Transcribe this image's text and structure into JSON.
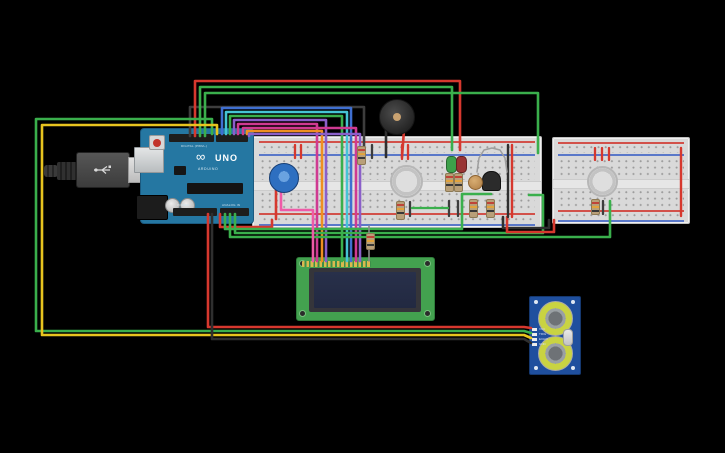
{
  "scene": {
    "background": "#000000"
  },
  "arduino": {
    "model": "UNO",
    "brand": "ARDUINO",
    "logo": "∞",
    "digital_label": "DIGITAL (PWM~)",
    "power_label": "POWER",
    "analog_label": "ANALOG IN"
  },
  "ultrasonic": {
    "pin_labels": [
      "VCC",
      "TRIG",
      "ECHO",
      "GND"
    ]
  },
  "palette": {
    "red": "#d6382e",
    "green": "#3aaf4c",
    "yellow": "#e7c41f",
    "black": "#2f2f2f",
    "dark": "#3d3d3d",
    "orange": "#ef8f21",
    "magenta": "#cf3a92",
    "pink": "#ef5aa7",
    "purple": "#8a5fc9",
    "cyan": "#45c4d4",
    "blue": "#3f6fd1",
    "gray": "#8a8a8a",
    "board_blue": "#2577a2",
    "lcd_green": "#43a14f",
    "sonar_blue": "#1f4f9e",
    "breadboard": "#d9d9d9"
  },
  "wires": [
    {
      "name": "gray-buzzer-signal",
      "color": "#3d3d3d",
      "pts": [
        [
          190,
          136
        ],
        [
          190,
          107
        ],
        [
          364,
          107
        ],
        [
          364,
          157
        ]
      ]
    },
    {
      "name": "red-top-loop",
      "color": "#d6382e",
      "pts": [
        [
          195,
          136
        ],
        [
          195,
          81
        ],
        [
          460,
          81
        ],
        [
          460,
          150
        ]
      ]
    },
    {
      "name": "green-top-a",
      "color": "#3aaf4c",
      "pts": [
        [
          200,
          136
        ],
        [
          200,
          87
        ],
        [
          452,
          87
        ],
        [
          452,
          150
        ]
      ]
    },
    {
      "name": "green-top-b",
      "color": "#3aaf4c",
      "pts": [
        [
          205,
          136
        ],
        [
          205,
          93
        ],
        [
          538,
          93
        ],
        [
          538,
          153
        ]
      ]
    },
    {
      "name": "green-echo",
      "color": "#3aaf4c",
      "pts": [
        [
          212,
          134
        ],
        [
          212,
          119
        ],
        [
          36,
          119
        ],
        [
          36,
          331
        ],
        [
          524,
          331
        ],
        [
          531,
          333
        ]
      ]
    },
    {
      "name": "yellow-trig",
      "color": "#e7c41f",
      "pts": [
        [
          217,
          134
        ],
        [
          217,
          125
        ],
        [
          42,
          125
        ],
        [
          42,
          335
        ],
        [
          524,
          335
        ],
        [
          531,
          338
        ]
      ]
    },
    {
      "name": "blue-lcd",
      "color": "#3f6fd1",
      "pts": [
        [
          222,
          134
        ],
        [
          222,
          108
        ],
        [
          351,
          108
        ],
        [
          351,
          261
        ]
      ]
    },
    {
      "name": "cyan-lcd",
      "color": "#45c4d4",
      "pts": [
        [
          226,
          134
        ],
        [
          226,
          112
        ],
        [
          347,
          112
        ],
        [
          347,
          261
        ]
      ]
    },
    {
      "name": "green-lcd",
      "color": "#3aaf4c",
      "pts": [
        [
          230,
          134
        ],
        [
          230,
          116
        ],
        [
          342,
          116
        ],
        [
          342,
          261
        ]
      ]
    },
    {
      "name": "purple-lcd-a",
      "color": "#8a5fc9",
      "pts": [
        [
          234,
          134
        ],
        [
          234,
          120
        ],
        [
          326,
          120
        ],
        [
          326,
          261
        ]
      ]
    },
    {
      "name": "magenta-lcd-a",
      "color": "#cf3a92",
      "pts": [
        [
          238,
          134
        ],
        [
          238,
          124
        ],
        [
          317,
          124
        ],
        [
          317,
          261
        ]
      ]
    },
    {
      "name": "magenta-lcd-b",
      "color": "#cf3a92",
      "pts": [
        [
          243,
          134
        ],
        [
          243,
          128
        ],
        [
          356,
          128
        ],
        [
          356,
          261
        ]
      ]
    },
    {
      "name": "orange-lcd",
      "color": "#ef8f21",
      "pts": [
        [
          247,
          134
        ],
        [
          247,
          131
        ],
        [
          322,
          131
        ],
        [
          322,
          261
        ]
      ]
    },
    {
      "name": "purple-lcd-b",
      "color": "#8a5fc9",
      "pts": [
        [
          249,
          136
        ],
        [
          249,
          134
        ],
        [
          360,
          134
        ],
        [
          360,
          261
        ]
      ]
    },
    {
      "name": "red-5v-sensor",
      "color": "#d6382e",
      "pts": [
        [
          208,
          214
        ],
        [
          208,
          327
        ],
        [
          524,
          327
        ],
        [
          531,
          328
        ]
      ]
    },
    {
      "name": "black-gnd-sensor",
      "color": "#2f2f2f",
      "pts": [
        [
          212,
          214
        ],
        [
          212,
          339
        ],
        [
          524,
          339
        ],
        [
          531,
          343
        ]
      ]
    },
    {
      "name": "red-rail-feed",
      "color": "#d6382e",
      "pts": [
        [
          220,
          214
        ],
        [
          220,
          227
        ],
        [
          272,
          227
        ],
        [
          272,
          220
        ]
      ]
    },
    {
      "name": "green-analog-a",
      "color": "#3aaf4c",
      "pts": [
        [
          225,
          214
        ],
        [
          225,
          229
        ],
        [
          462,
          229
        ],
        [
          462,
          194
        ],
        [
          491,
          194
        ]
      ]
    },
    {
      "name": "green-analog-c",
      "color": "#3aaf4c",
      "pts": [
        [
          235,
          214
        ],
        [
          235,
          233
        ],
        [
          543,
          233
        ],
        [
          543,
          195
        ],
        [
          529,
          195
        ]
      ]
    },
    {
      "name": "green-analog-b",
      "color": "#3aaf4c",
      "pts": [
        [
          230,
          214
        ],
        [
          230,
          237
        ],
        [
          610,
          237
        ],
        [
          610,
          201
        ]
      ]
    },
    {
      "name": "black-right-feed",
      "color": "#2f2f2f",
      "pts": [
        [
          503,
          217
        ],
        [
          503,
          228
        ],
        [
          549,
          228
        ],
        [
          549,
          220
        ]
      ]
    },
    {
      "name": "red-right-feed",
      "color": "#d6382e",
      "pts": [
        [
          507,
          217
        ],
        [
          507,
          232
        ],
        [
          554,
          232
        ],
        [
          554,
          220
        ]
      ]
    },
    {
      "name": "black-long-main",
      "color": "#2f2f2f",
      "w": 2.4,
      "pts": [
        [
          508,
          145
        ],
        [
          508,
          217
        ]
      ]
    },
    {
      "name": "red-long-main",
      "color": "#d6382e",
      "w": 2.4,
      "pts": [
        [
          512,
          145
        ],
        [
          512,
          217
        ]
      ]
    },
    {
      "name": "red-long-right",
      "color": "#d6382e",
      "w": 2.4,
      "pts": [
        [
          681,
          148
        ],
        [
          681,
          216
        ]
      ]
    },
    {
      "name": "buzzer-leg-black",
      "color": "#2f2f2f",
      "pts": [
        [
          386,
          129
        ],
        [
          386,
          157
        ]
      ]
    },
    {
      "name": "buzzer-leg-red",
      "color": "#d6382e",
      "pts": [
        [
          404,
          130
        ],
        [
          402,
          157
        ]
      ]
    },
    {
      "name": "pink-pot-lcd",
      "color": "#ef5aa7",
      "pts": [
        [
          281,
          188
        ],
        [
          281,
          210
        ],
        [
          313,
          210
        ],
        [
          313,
          261
        ]
      ]
    },
    {
      "name": "red-pot-leg",
      "color": "#d6382e",
      "pts": [
        [
          276,
          188
        ],
        [
          276,
          219
        ]
      ]
    },
    {
      "name": "red-jumper-1",
      "color": "#d6382e",
      "w": 2.3,
      "pts": [
        [
          295,
          145
        ],
        [
          295,
          158
        ]
      ]
    },
    {
      "name": "red-jumper-2",
      "color": "#d6382e",
      "w": 2.3,
      "pts": [
        [
          301,
          145
        ],
        [
          301,
          158
        ]
      ]
    },
    {
      "name": "red-jumper-3",
      "color": "#d6382e",
      "w": 2.3,
      "pts": [
        [
          402,
          145
        ],
        [
          402,
          159
        ]
      ]
    },
    {
      "name": "red-jumper-4",
      "color": "#d6382e",
      "w": 2.3,
      "pts": [
        [
          408,
          145
        ],
        [
          408,
          159
        ]
      ]
    },
    {
      "name": "red-jumper-5",
      "color": "#d6382e",
      "w": 2.3,
      "pts": [
        [
          595,
          148
        ],
        [
          595,
          160
        ]
      ]
    },
    {
      "name": "red-jumper-6",
      "color": "#d6382e",
      "w": 2.3,
      "pts": [
        [
          602,
          148
        ],
        [
          602,
          160
        ]
      ]
    },
    {
      "name": "red-jumper-7",
      "color": "#d6382e",
      "w": 2.3,
      "pts": [
        [
          609,
          148
        ],
        [
          609,
          160
        ]
      ]
    },
    {
      "name": "dark-jumper-1",
      "color": "#3d3d3d",
      "w": 2.3,
      "pts": [
        [
          449,
          201
        ],
        [
          449,
          216
        ]
      ]
    },
    {
      "name": "dark-jumper-2",
      "color": "#3d3d3d",
      "w": 2.3,
      "pts": [
        [
          458,
          201
        ],
        [
          458,
          216
        ]
      ]
    },
    {
      "name": "dark-jumper-3",
      "color": "#3d3d3d",
      "w": 2.3,
      "pts": [
        [
          603,
          201
        ],
        [
          603,
          214
        ]
      ]
    },
    {
      "name": "dark-jumper-4",
      "color": "#3d3d3d",
      "w": 2.3,
      "pts": [
        [
          410,
          202
        ],
        [
          410,
          216
        ]
      ]
    },
    {
      "name": "dark-jumper-5",
      "color": "#3d3d3d",
      "w": 2.3,
      "pts": [
        [
          372,
          145
        ],
        [
          372,
          158
        ]
      ]
    },
    {
      "name": "green-jumper-mid",
      "color": "#3aaf4c",
      "w": 2.3,
      "pts": [
        [
          412,
          208
        ],
        [
          448,
          208
        ]
      ]
    },
    {
      "name": "resistor-lead-top",
      "color": "#8a8a8a",
      "w": 1.6,
      "pts": [
        [
          369,
          226
        ],
        [
          369,
          234
        ]
      ]
    },
    {
      "name": "resistor-lead-bottom",
      "color": "#8a8a8a",
      "w": 1.6,
      "pts": [
        [
          369,
          248
        ],
        [
          369,
          261
        ]
      ]
    },
    {
      "name": "gray-arc-transistor",
      "color": "#9e9e9e",
      "w": 1.5,
      "pts": [
        [
          477,
          172
        ],
        [
          479,
          158
        ],
        [
          484,
          150
        ],
        [
          492,
          148
        ],
        [
          500,
          150
        ],
        [
          505,
          158
        ],
        [
          507,
          172
        ]
      ]
    }
  ]
}
